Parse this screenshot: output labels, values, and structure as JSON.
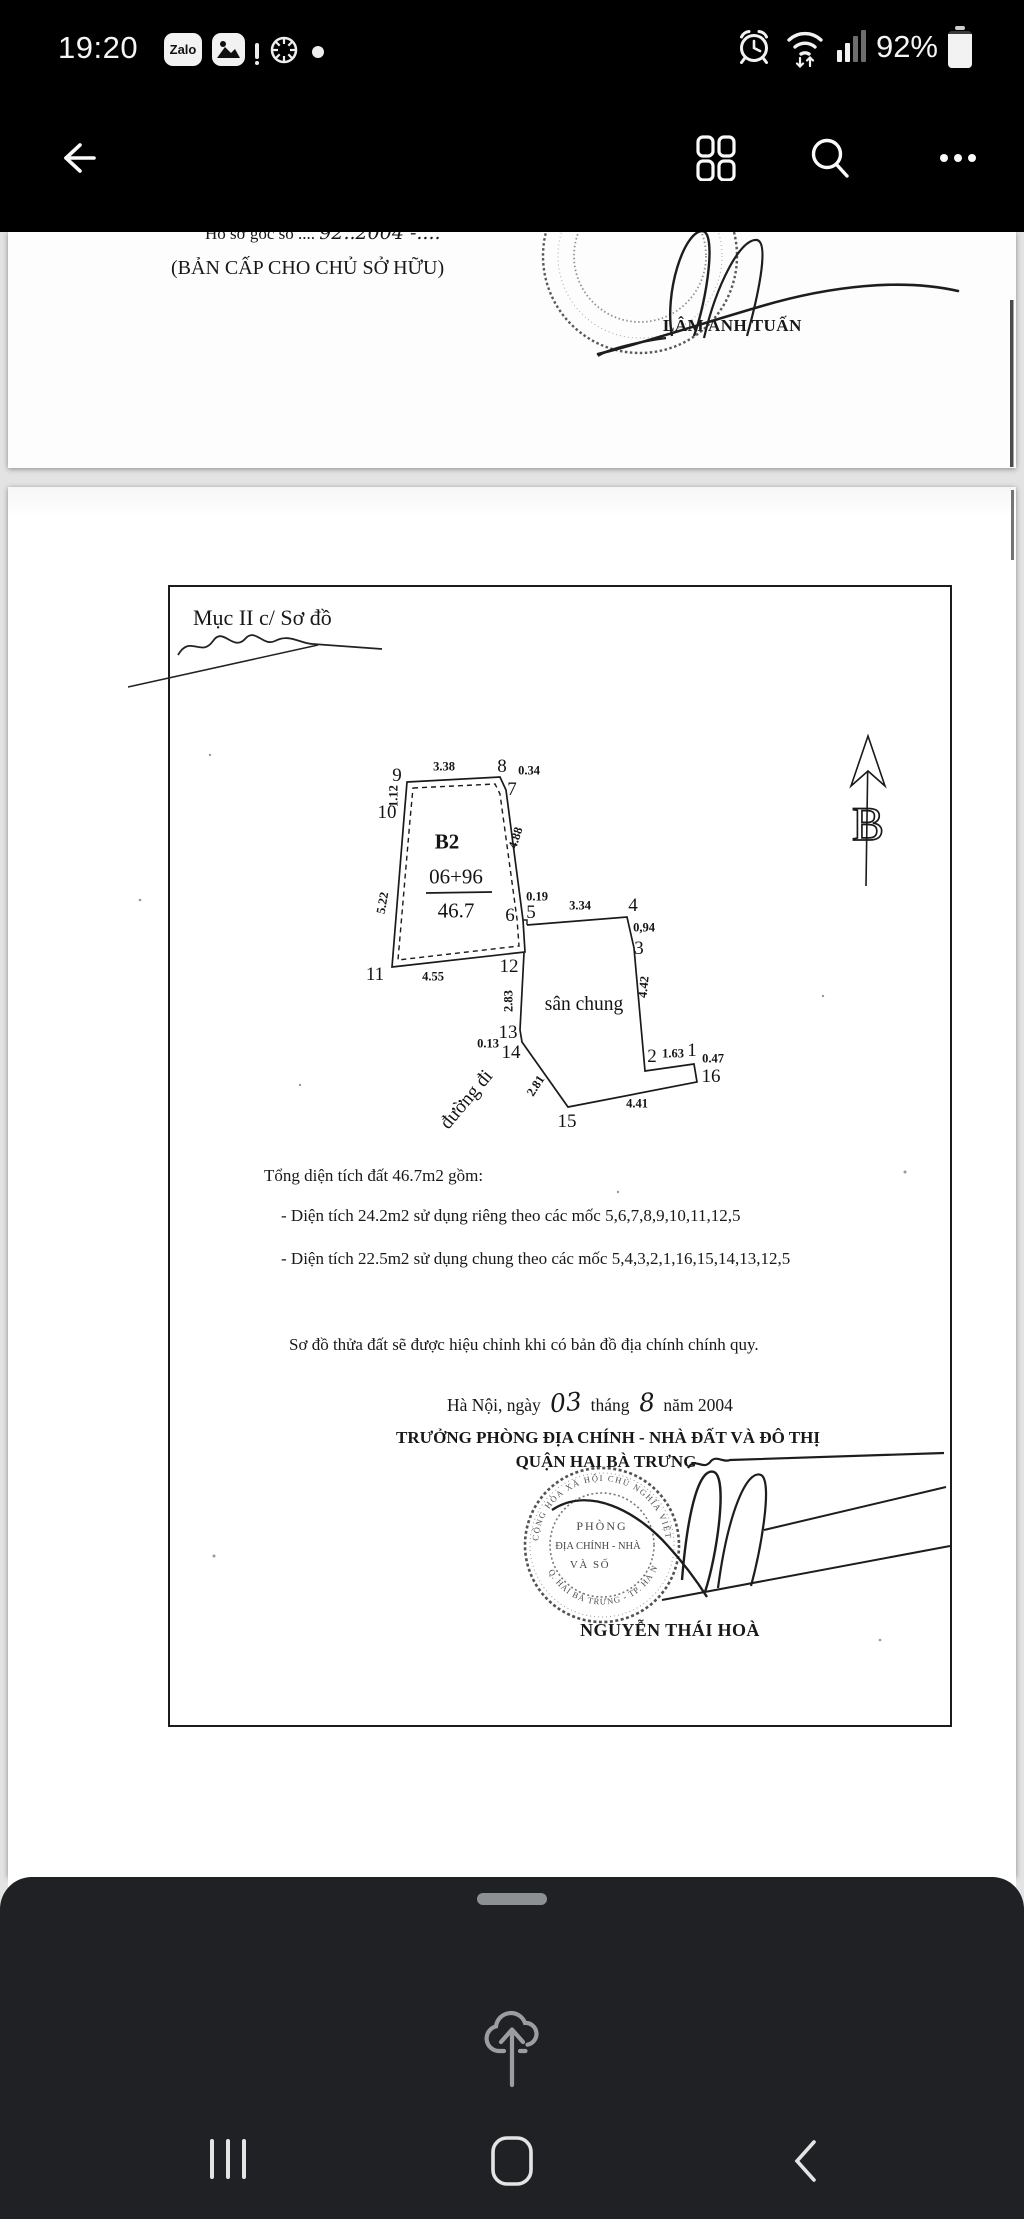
{
  "status_bar": {
    "time": "19:20",
    "battery": "92%",
    "zalo_label": "Zalo"
  },
  "page1": {
    "file_line_prefix": "Hồ sơ gốc số ....",
    "file_line_handwritten": "92..2004 -....",
    "copy_line": "(BẢN CẤP CHO CHỦ SỞ HỮU)",
    "signer": "LÂM ANH TUẤN"
  },
  "page2": {
    "section_heading": "Mục II c/ Sơ đồ",
    "north_label": "B",
    "diagram": {
      "labels": [
        {
          "t": "9",
          "x": 397,
          "y": 776
        },
        {
          "t": "3.38",
          "x": 444,
          "y": 767,
          "s": 12.5,
          "w": 700
        },
        {
          "t": "8",
          "x": 502,
          "y": 767
        },
        {
          "t": "0.34",
          "x": 529,
          "y": 771,
          "s": 12.5,
          "w": 700
        },
        {
          "t": "7",
          "x": 512,
          "y": 790
        },
        {
          "t": "10",
          "x": 387,
          "y": 813
        },
        {
          "t": "1.12",
          "x": 394,
          "y": 796,
          "s": 12.5,
          "w": 700,
          "r": -90
        },
        {
          "t": "B2",
          "x": 447,
          "y": 842,
          "s": 21,
          "w": 700
        },
        {
          "t": "4.88",
          "x": 516,
          "y": 838,
          "s": 12.5,
          "w": 700,
          "r": -72
        },
        {
          "t": "06+96",
          "x": 456,
          "y": 877,
          "s": 21
        },
        {
          "t": "46.7",
          "x": 456,
          "y": 911,
          "s": 21
        },
        {
          "t": "5.22",
          "x": 383,
          "y": 903,
          "s": 12.5,
          "w": 700,
          "r": -80
        },
        {
          "t": "0.19",
          "x": 537,
          "y": 897,
          "s": 12.5,
          "w": 700
        },
        {
          "t": "6",
          "x": 510,
          "y": 916
        },
        {
          "t": "5",
          "x": 531,
          "y": 913
        },
        {
          "t": "3.34",
          "x": 580,
          "y": 906,
          "s": 12.5,
          "w": 700
        },
        {
          "t": "4",
          "x": 633,
          "y": 906
        },
        {
          "t": "0,94",
          "x": 644,
          "y": 928,
          "s": 12.5,
          "w": 700
        },
        {
          "t": "3",
          "x": 639,
          "y": 949
        },
        {
          "t": "11",
          "x": 375,
          "y": 975
        },
        {
          "t": "4.55",
          "x": 433,
          "y": 977,
          "s": 12.5,
          "w": 700
        },
        {
          "t": "12",
          "x": 509,
          "y": 967
        },
        {
          "t": "2.83",
          "x": 509,
          "y": 1001,
          "s": 12.5,
          "w": 700,
          "r": -90
        },
        {
          "t": "sân chung",
          "x": 584,
          "y": 1005,
          "s": 19.5
        },
        {
          "t": "4.42",
          "x": 644,
          "y": 987,
          "s": 12.5,
          "w": 700,
          "r": -84
        },
        {
          "t": "13",
          "x": 508,
          "y": 1033
        },
        {
          "t": "0.13",
          "x": 488,
          "y": 1044,
          "s": 12.5,
          "w": 700
        },
        {
          "t": "14",
          "x": 511,
          "y": 1053
        },
        {
          "t": "2",
          "x": 652,
          "y": 1057
        },
        {
          "t": "1.63",
          "x": 673,
          "y": 1054,
          "s": 12.5,
          "w": 700
        },
        {
          "t": "1",
          "x": 692,
          "y": 1051
        },
        {
          "t": "0.47",
          "x": 713,
          "y": 1059,
          "s": 12.5,
          "w": 700
        },
        {
          "t": "16",
          "x": 711,
          "y": 1077
        },
        {
          "t": "đường đi",
          "x": 467,
          "y": 1100,
          "s": 19.5,
          "r": -50
        },
        {
          "t": "2.81",
          "x": 536,
          "y": 1086,
          "s": 12.5,
          "w": 700,
          "r": -57
        },
        {
          "t": "15",
          "x": 567,
          "y": 1122
        },
        {
          "t": "4.41",
          "x": 637,
          "y": 1104,
          "s": 12.5,
          "w": 700
        }
      ]
    },
    "area_summary": {
      "total": "Tổng diện tích đất 46.7m2 gồm:",
      "items": [
        "- Diện tích 24.2m2 sử dụng riêng theo các mốc 5,6,7,8,9,10,11,12,5",
        "- Diện tích 22.5m2 sử dụng chung theo các mốc 5,4,3,2,1,16,15,14,13,12,5"
      ]
    },
    "note": "Sơ đồ thửa đất sẽ được hiệu chỉnh khi có bản đồ địa chính chính quy.",
    "date_line": {
      "prefix": "Hà Nội, ngày",
      "day": "03",
      "middle": "tháng",
      "month": "8",
      "suffix": "năm 2004"
    },
    "office_line1": "TRƯỞNG PHÒNG ĐỊA CHÍNH - NHÀ ĐẤT VÀ ĐÔ THỊ",
    "office_line2": "QUẬN HAI BÀ TRƯNG",
    "stamp": {
      "arc_top": "CỘNG HÒA XÃ HỘI CHỦ NGHĨA VIỆT NAM",
      "line1": "PHÒNG",
      "line2": "ĐỊA CHÍNH - NHÀ",
      "line3": "VÀ SỐ",
      "arc_bottom": "Q. HAI BÀ TRƯNG - TP. HÀ NỘI"
    },
    "signer": "NGUYỄN THÁI HOÀ"
  }
}
